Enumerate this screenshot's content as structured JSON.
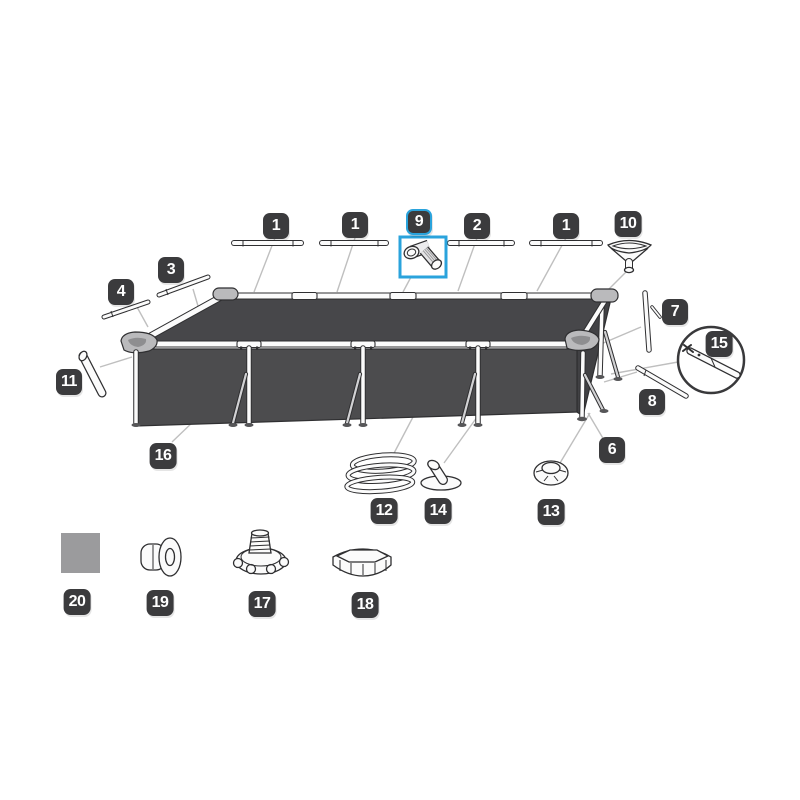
{
  "colors": {
    "bg": "#ffffff",
    "badge_bg": "#3b3b3d",
    "badge_text": "#ffffff",
    "highlight": "#2aa3dc",
    "outline": "#2f2f31",
    "pool_top": "#47474a",
    "pool_wall": "#4c4c4e",
    "pool_side": "#414144",
    "leader": "#bfbfbf",
    "patch": "#9b9b9d"
  },
  "selected_part": "9",
  "callouts": [
    {
      "id": "1a",
      "text": "1",
      "x": 276,
      "y": 226,
      "selected": false
    },
    {
      "id": "1b",
      "text": "1",
      "x": 355,
      "y": 225,
      "selected": false
    },
    {
      "id": "9",
      "text": "9",
      "x": 419,
      "y": 222,
      "selected": true
    },
    {
      "id": "2",
      "text": "2",
      "x": 477,
      "y": 226,
      "selected": false
    },
    {
      "id": "1c",
      "text": "1",
      "x": 566,
      "y": 226,
      "selected": false
    },
    {
      "id": "10",
      "text": "10",
      "x": 628,
      "y": 224,
      "selected": false
    },
    {
      "id": "3",
      "text": "3",
      "x": 171,
      "y": 270,
      "selected": false
    },
    {
      "id": "4",
      "text": "4",
      "x": 121,
      "y": 292,
      "selected": false
    },
    {
      "id": "7",
      "text": "7",
      "x": 675,
      "y": 312,
      "selected": false
    },
    {
      "id": "15",
      "text": "15",
      "x": 719,
      "y": 344,
      "selected": false
    },
    {
      "id": "11",
      "text": "11",
      "x": 69,
      "y": 382,
      "selected": false
    },
    {
      "id": "8",
      "text": "8",
      "x": 652,
      "y": 402,
      "selected": false
    },
    {
      "id": "16",
      "text": "16",
      "x": 163,
      "y": 456,
      "selected": false
    },
    {
      "id": "6",
      "text": "6",
      "x": 612,
      "y": 450,
      "selected": false
    },
    {
      "id": "12",
      "text": "12",
      "x": 384,
      "y": 511,
      "selected": false
    },
    {
      "id": "14",
      "text": "14",
      "x": 438,
      "y": 511,
      "selected": false
    },
    {
      "id": "13",
      "text": "13",
      "x": 551,
      "y": 512,
      "selected": false
    },
    {
      "id": "20",
      "text": "20",
      "x": 77,
      "y": 602,
      "selected": false
    },
    {
      "id": "19",
      "text": "19",
      "x": 160,
      "y": 603,
      "selected": false
    },
    {
      "id": "17",
      "text": "17",
      "x": 262,
      "y": 604,
      "selected": false
    },
    {
      "id": "18",
      "text": "18",
      "x": 365,
      "y": 605,
      "selected": false
    }
  ]
}
